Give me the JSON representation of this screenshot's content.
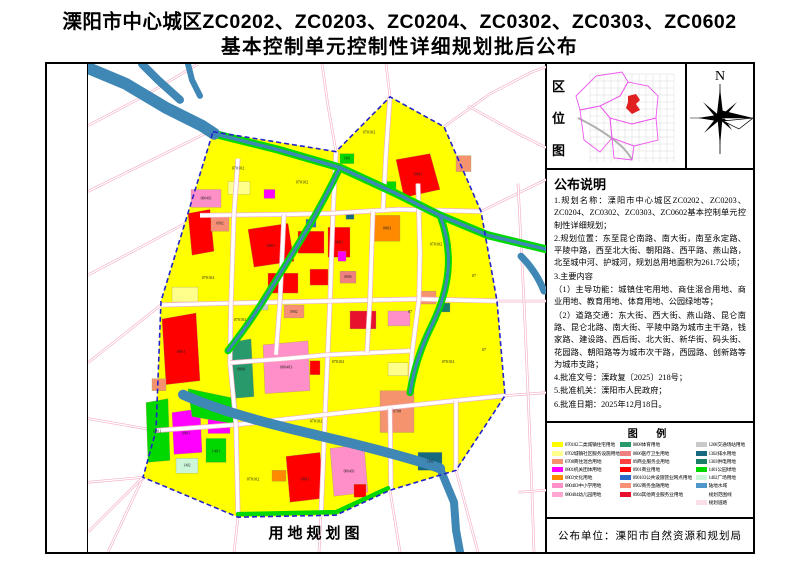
{
  "title": {
    "line1": "溧阳市中心城区ZC0202、ZC0203、ZC0204、ZC0302、ZC0303、ZC0602",
    "line2": "基本控制单元控制性详细规划批后公布"
  },
  "map_panel": {
    "caption": "用地规划图"
  },
  "location": {
    "chars": [
      "区",
      "位",
      "图"
    ]
  },
  "compass": {
    "north_label": "N"
  },
  "announcement": {
    "heading": "公布说明",
    "items": [
      "1.规划名称：溧阳市中心城区ZC0202、ZC0203、ZC0204、ZC0302、ZC0303、ZC0602基本控制单元控制性详细规划；",
      "2.规划位置：东至昆仑南路、南大街，南至永定路、平陵中路，西至北大街、朝阳路、西平路、燕山路，北至城中河、护城河，规划总用地面积为261.7公顷；",
      "3.主要内容",
      "（1）主导功能：城镇住宅用地、商住混合用地、商业用地、教育用地、体育用地、公园绿地等；",
      "（2）道路交通：东大街、西大街、燕山路、昆仑南路、昆仑北路、南大街、平陵中路为城市主干路，钱家路、建设路、西后街、北大街、新华街、码头街、花园路、朝阳路等为城市次干路，西园路、创新路等为城市支路；",
      "4.批准文号：溧政复〔2025〕218号；",
      "5.批准机关：溧阳市人民政府；",
      "6.批准日期：2025年12月18日。"
    ]
  },
  "legend": {
    "heading": "图  例",
    "columns": [
      [
        {
          "code": "070102",
          "name": "二类城镇住宅用地",
          "color": "#FFFF00"
        },
        {
          "code": "0702",
          "name": "城镇社区服务设施用地",
          "color": "#FFFF8C"
        },
        {
          "code": "0708",
          "name": "商住混合用地",
          "color": "#F4936E"
        },
        {
          "code": "0801",
          "name": "机关团体用地",
          "color": "#FF00FF"
        },
        {
          "code": "0803",
          "name": "文化用地",
          "color": "#FF8A00"
        },
        {
          "code": "080403",
          "name": "中小学用地",
          "color": "#FF8FC8"
        },
        {
          "code": "080404",
          "name": "幼儿园用地",
          "color": "#FFA6D2"
        }
      ],
      [
        {
          "code": "0808",
          "name": "体育用地",
          "color": "#27996B"
        },
        {
          "code": "0806",
          "name": "医疗卫生用地",
          "color": "#F08080"
        },
        {
          "code": "09",
          "name": "商业服务业用地",
          "color": "#FF4040"
        },
        {
          "code": "0901",
          "name": "商业用地",
          "color": "#FF0000"
        },
        {
          "code": "090103",
          "name": "公共设施营业网点用地",
          "color": "#2A6BC8"
        },
        {
          "code": "0902",
          "name": "商务金融用地",
          "color": "#F89078"
        },
        {
          "code": "0904",
          "name": "其他商业服务业用地",
          "color": "#E8112D"
        }
      ],
      [
        {
          "code": "1208",
          "name": "交通场站用地",
          "color": "#C9C9C9"
        },
        {
          "code": "1302",
          "name": "排水用地",
          "color": "#17697F"
        },
        {
          "code": "1303",
          "name": "供电用地",
          "color": "#1A7F68"
        },
        {
          "code": "1401",
          "name": "公园绿地",
          "color": "#00D800"
        },
        {
          "code": "1402",
          "name": "广场用地",
          "color": "#CDF5DA"
        },
        {
          "code": "",
          "name": "陆地水域",
          "color": "#4E97C8"
        },
        {
          "code": "",
          "name": "规划范围线",
          "color": "#2323CC",
          "type": "dashed-line"
        },
        {
          "code": "",
          "name": "规划道路",
          "color": "#FBDFE6"
        }
      ]
    ]
  },
  "publisher": {
    "text": "公布单位：溧阳市自然资源和规划局"
  },
  "location_map": {
    "grid": {
      "x0": 20,
      "x1": 104,
      "y0": 8,
      "y1": 96,
      "step": 7
    },
    "ring_road": "M8,52 C24,60 34,66 44,74 C52,80 58,86 62,94",
    "districts": [
      "6,30 26,10 52,6 58,16 50,30 30,40 10,44",
      "30,40 50,30 58,16 78,20 88,30 86,52 62,58 40,52",
      "40,52 62,58 86,52 88,74 64,80 42,72",
      "10,44 30,40 40,52 42,72 30,86 14,74",
      "42,72 64,80 62,94 44,92"
    ],
    "highlight": "58,30 66,28 70,34 66,38 70,44 62,48 56,42 58,36",
    "colors": {
      "district": "#EE55EE",
      "highlight": "#E02020"
    }
  },
  "map": {
    "colors": {
      "base": "#FFFF00",
      "road_edge": "#F3AFC6",
      "water": "#3F87B5",
      "green": "#00D800",
      "boundary": "#2323CC"
    },
    "boundary": "125,68 248,88 302,33 356,63 393,148 409,238 417,333 368,408 302,428 248,453 150,455 55,415 68,368 73,238",
    "outside_roads": [
      "M0,62 L60,30 110,0",
      "M0,128 L125,66",
      "M0,212 L60,180 112,152",
      "M0,300 L73,242",
      "M0,356 L68,368",
      "M0,420 L55,415",
      "M20,490 L55,415",
      "M55,415 L0,470",
      "M150,455 L146,490",
      "M233,453 L231,490",
      "M302,428 L312,490",
      "M368,408 L390,490",
      "M417,333 L458,330",
      "M409,238 L458,238",
      "M393,148 L458,116",
      "M356,63 L402,30 444,8 458,3",
      "M302,33 L298,0",
      "M248,88 L240,42 234,0",
      "M430,120 L436,238 440,330 444,430 446,490",
      "M430,430 L458,428",
      "M380,42 L430,70 458,84"
    ],
    "inner_roads": [
      "M248,88 L245,150 242,238 238,330 233,453",
      "M73,242 L150,240 242,238 330,236 409,238",
      "M112,152 L200,151 242,150 310,146 393,148",
      "M68,368 L150,362 238,352 302,345 368,338 417,333",
      "M150,95 L146,150 143,240 142,300 148,362 150,452",
      "M330,120 L332,190 331,236 324,290 322,330",
      "M302,33 L298,90 295,146",
      "M302,345 L303,428",
      "M368,338 L368,408",
      "M142,300 L196,296 240,292 322,288",
      "M196,151 L192,238 188,292",
      "M285,148 L282,236 279,290"
    ],
    "greenways": [
      {
        "d": "M126,70 L190,86 252,104 308,130 352,152 400,172 458,186",
        "w": 8
      },
      {
        "d": "M252,104 C230,150 205,190 180,230 C165,255 152,272 140,288",
        "w": 7
      },
      {
        "d": "M352,152 C366,190 362,225 344,262 C334,282 326,305 322,330",
        "w": 7
      },
      {
        "d": "M150,452 L248,450 300,426",
        "w": 4.5
      }
    ],
    "rivers": [
      {
        "d": "M0,4 L38,20 78,44 114,62 126,70",
        "w": 12
      },
      {
        "d": "M54,0 L70,16 92,36",
        "w": 8
      },
      {
        "d": "M100,0 L104,16 112,32",
        "w": 6
      },
      {
        "d": "M126,70 L190,86 252,104 308,130 352,152 400,172 458,186",
        "w": 3.5
      },
      {
        "d": "M252,104 C230,150 205,190 180,230 C165,255 152,272 140,288",
        "w": 3
      },
      {
        "d": "M352,152 C366,190 362,225 344,262 C334,282 326,305 322,330",
        "w": 3
      },
      {
        "d": "M95,332 C140,352 200,366 260,380 C300,390 330,398 352,406",
        "w": 10
      },
      {
        "d": "M352,406 L366,440 368,468 372,490",
        "w": 8
      },
      {
        "d": "M433,193 C445,205 452,218 456,228",
        "w": 7
      }
    ],
    "parcels": [
      {
        "r": [
          252,
          90,
          14,
          10
        ],
        "c": "#00D800"
      },
      {
        "r": [
          296,
          118,
          12,
          9
        ],
        "c": "#00D800"
      },
      {
        "pts": "308,96 342,90 352,126 316,134",
        "c": "#FF0000"
      },
      {
        "r": [
          368,
          92,
          15,
          16
        ],
        "c": "#F4936E"
      },
      {
        "pts": "100,150 122,146 126,188 104,192",
        "c": "#FF0000"
      },
      {
        "r": [
          103,
          126,
          30,
          18
        ],
        "c": "#FF8FC8"
      },
      {
        "r": [
          123,
          152,
          18,
          16
        ],
        "c": "#F89078"
      },
      {
        "r": [
          140,
          118,
          22,
          13
        ],
        "c": "#FFFF8C"
      },
      {
        "r": [
          176,
          126,
          11,
          9
        ],
        "c": "#FF00FF"
      },
      {
        "pts": "160,166 200,160 206,198 166,204",
        "c": "#FF0000"
      },
      {
        "r": [
          210,
          168,
          26,
          22
        ],
        "c": "#FF0000"
      },
      {
        "r": [
          240,
          164,
          22,
          30
        ],
        "c": "#FF0000"
      },
      {
        "r": [
          180,
          210,
          30,
          20
        ],
        "c": "#FF0000"
      },
      {
        "r": [
          222,
          206,
          18,
          16
        ],
        "c": "#FF0000"
      },
      {
        "r": [
          218,
          156,
          10,
          8
        ],
        "c": "#2A6BC8"
      },
      {
        "r": [
          196,
          242,
          20,
          13
        ],
        "c": "#F89078"
      },
      {
        "r": [
          252,
          208,
          16,
          12
        ],
        "c": "#F08080"
      },
      {
        "r": [
          286,
          152,
          26,
          26
        ],
        "c": "#FF8A00"
      },
      {
        "r": [
          258,
          148,
          8,
          8
        ],
        "c": "#17697F"
      },
      {
        "r": [
          262,
          248,
          26,
          18
        ],
        "c": "#E8112D"
      },
      {
        "r": [
          250,
          188,
          8,
          10
        ],
        "c": "#FF00FF"
      },
      {
        "r": [
          330,
          228,
          18,
          13
        ],
        "c": "#F4936E"
      },
      {
        "r": [
          300,
          248,
          22,
          15
        ],
        "c": "#FF8FC8"
      },
      {
        "pts": "74,256 108,250 112,318 78,322",
        "c": "#FF0000"
      },
      {
        "r": [
          84,
          224,
          26,
          15
        ],
        "c": "#FFFF8C"
      },
      {
        "pts": "140,280 163,276 166,334 143,336",
        "c": "#27996B"
      },
      {
        "pts": "175,282 220,278 222,328 177,331",
        "c": "#FF8FC8"
      },
      {
        "r": [
          222,
          298,
          10,
          14
        ],
        "c": "#FF0000"
      },
      {
        "pts": "84,350 112,346 114,390 86,392",
        "c": "#FF00FF"
      },
      {
        "r": [
          120,
          354,
          22,
          17
        ],
        "c": "#FF00FF"
      },
      {
        "pts": "58,340 80,336 82,398 60,400",
        "c": "#00D800"
      },
      {
        "r": [
          118,
          376,
          20,
          24
        ],
        "c": "#00D800"
      },
      {
        "r": [
          88,
          396,
          22,
          15
        ],
        "c": "#CDF5DA"
      },
      {
        "r": [
          64,
          316,
          14,
          12
        ],
        "c": "#F4936E"
      },
      {
        "pts": "100,326 148,336 150,362 104,354",
        "c": "#00D800"
      },
      {
        "pts": "198,394 232,390 236,436 202,440",
        "c": "#FF0000"
      },
      {
        "r": [
          184,
          408,
          14,
          11
        ],
        "c": "#FF8A00"
      },
      {
        "pts": "242,386 276,382 280,430 246,434",
        "c": "#FF8FC8"
      },
      {
        "r": [
          266,
          422,
          12,
          13
        ],
        "c": "#FF0000"
      },
      {
        "r": [
          330,
          390,
          24,
          18
        ],
        "c": "#17697F"
      },
      {
        "r": [
          292,
          328,
          34,
          42
        ],
        "c": "#F4936E"
      },
      {
        "r": [
          300,
          300,
          20,
          13
        ],
        "c": "#FFFF8C"
      },
      {
        "r": [
          168,
          238,
          12,
          9
        ],
        "c": "#C9C9C9"
      },
      {
        "r": [
          352,
          240,
          10,
          9
        ],
        "c": "#1A7F68"
      }
    ],
    "labels": [
      {
        "t": "070102",
        "x": 281,
        "y": 70
      },
      {
        "t": "0901",
        "x": 330,
        "y": 112
      },
      {
        "t": "1401",
        "x": 259,
        "y": 96,
        "s": 3.6
      },
      {
        "t": "070102",
        "x": 150,
        "y": 106
      },
      {
        "t": "070102",
        "x": 214,
        "y": 120
      },
      {
        "t": "080403",
        "x": 118,
        "y": 136,
        "s": 3.6
      },
      {
        "t": "0902",
        "x": 132,
        "y": 161,
        "s": 3.6
      },
      {
        "t": "0901",
        "x": 183,
        "y": 184
      },
      {
        "t": "0901",
        "x": 251,
        "y": 180
      },
      {
        "t": "0803",
        "x": 299,
        "y": 166
      },
      {
        "t": "070102",
        "x": 120,
        "y": 216
      },
      {
        "t": "070102",
        "x": 152,
        "y": 258
      },
      {
        "t": "0901",
        "x": 93,
        "y": 290
      },
      {
        "t": "0808",
        "x": 153,
        "y": 308
      },
      {
        "t": "080403",
        "x": 198,
        "y": 306
      },
      {
        "t": "070102",
        "x": 250,
        "y": 300
      },
      {
        "t": "0806",
        "x": 260,
        "y": 215,
        "s": 3.6
      },
      {
        "t": "0902",
        "x": 206,
        "y": 250,
        "s": 3.6
      },
      {
        "t": "0801",
        "x": 98,
        "y": 372
      },
      {
        "t": "1401",
        "x": 69,
        "y": 370
      },
      {
        "t": "1401",
        "x": 128,
        "y": 390
      },
      {
        "t": "1402",
        "x": 99,
        "y": 404,
        "s": 3.6
      },
      {
        "t": "070102",
        "x": 165,
        "y": 418
      },
      {
        "t": "0901",
        "x": 217,
        "y": 418
      },
      {
        "t": "080403",
        "x": 261,
        "y": 410,
        "s": 3.6
      },
      {
        "t": "0708",
        "x": 309,
        "y": 350
      },
      {
        "t": "070102",
        "x": 360,
        "y": 300
      },
      {
        "t": "07",
        "x": 386,
        "y": 214
      },
      {
        "t": "07",
        "x": 396,
        "y": 288
      },
      {
        "t": "070102",
        "x": 348,
        "y": 182
      },
      {
        "t": "1302",
        "x": 342,
        "y": 400,
        "s": 3.6
      },
      {
        "t": "070102",
        "x": 228,
        "y": 360
      },
      {
        "t": "07",
        "x": 322,
        "y": 250
      }
    ]
  }
}
